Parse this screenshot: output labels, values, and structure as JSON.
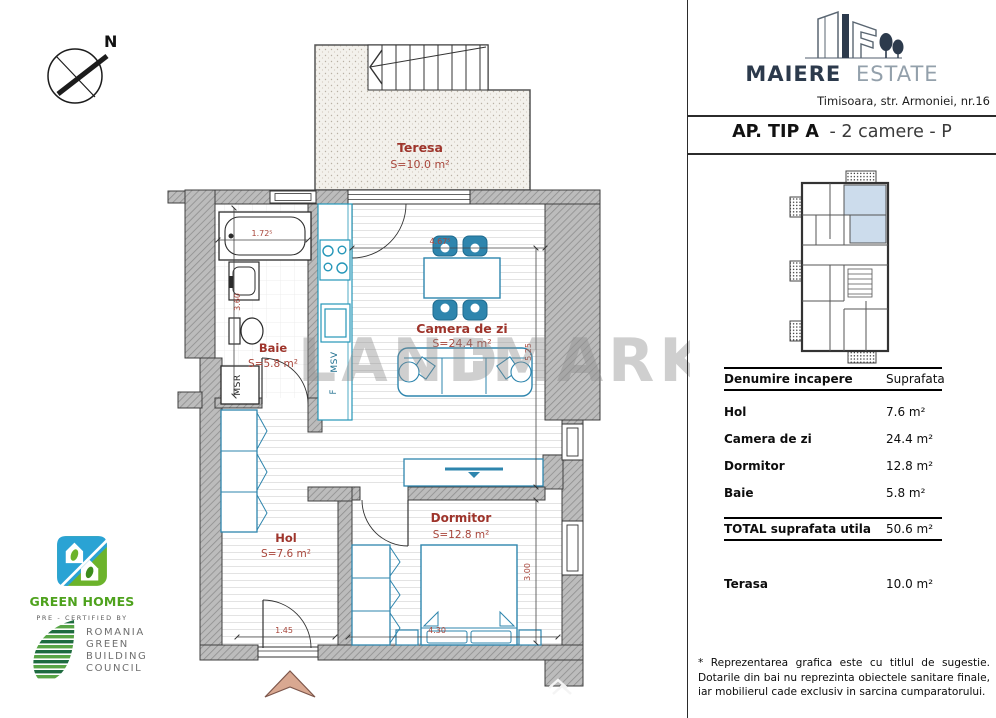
{
  "colors": {
    "wall_gray": "#bcbcbc",
    "furniture_blue": "#2e85ad",
    "label_red": "#9e342b",
    "highlight_blue": "#ccdcec",
    "logo_navy": "#2c3a4c",
    "green_homes_green": "#6cb32b",
    "green_homes_blue": "#2aa3d4",
    "arrow_tan": "#d9a891"
  },
  "compass": {
    "label": "N"
  },
  "watermark": {
    "left": "LAND",
    "right": "MARK"
  },
  "brand": {
    "name": "MAIERE",
    "suffix": "ESTATE",
    "address": "Timisoara, str. Armoniei, nr.16"
  },
  "title": {
    "bold": "AP. TIP A",
    "rest": "- 2 camere - P"
  },
  "plan": {
    "rooms": {
      "terasa": {
        "name": "Teresa",
        "area": "S=10.0 m²"
      },
      "baie": {
        "name": "Baie",
        "area": "S=5.8 m²"
      },
      "camera_de_zi": {
        "name": "Camera de zi",
        "area": "S=24.4 m²"
      },
      "hol": {
        "name": "Hol",
        "area": "S=7.6 m²"
      },
      "dormitor": {
        "name": "Dormitor",
        "area": "S=12.8 m²"
      }
    },
    "labels": {
      "msr": "MSR",
      "msv": "MSV",
      "fridge": "F"
    },
    "dims": {
      "bath": "1.72⁵",
      "bath_depth": "3.60",
      "living_w": "4.67⁵",
      "living_h": "5.25",
      "entry": "1.45",
      "bed_w": "4.30",
      "bed_h": "3.00"
    }
  },
  "legend_table": {
    "col_room": "Denumire incapere",
    "col_area": "Suprafata",
    "rows": [
      {
        "label": "Hol",
        "value": "7.6 m²"
      },
      {
        "label": "Camera de zi",
        "value": "24.4 m²"
      },
      {
        "label": "Dormitor",
        "value": "12.8 m²"
      },
      {
        "label": "Baie",
        "value": "5.8 m²"
      }
    ],
    "total_label": "TOTAL suprafata utila",
    "total_value": "50.6 m²",
    "terrace_label": "Terasa",
    "terrace_value": "10.0 m²"
  },
  "footnote": {
    "line1": "* Reprezentarea grafica este cu titlul de sugestie.",
    "line2": "Dotarile din bai nu reprezinta obiectele sanitare finale,",
    "line3": "iar mobilierul cade exclusiv in sarcina cumparatorului."
  },
  "certifications": {
    "green_homes": "GREEN HOMES",
    "pre_certified": "PRE - CERTIFIED BY",
    "council": [
      "ROMANIA",
      "GREEN",
      "BUILDING",
      "COUNCIL"
    ]
  }
}
